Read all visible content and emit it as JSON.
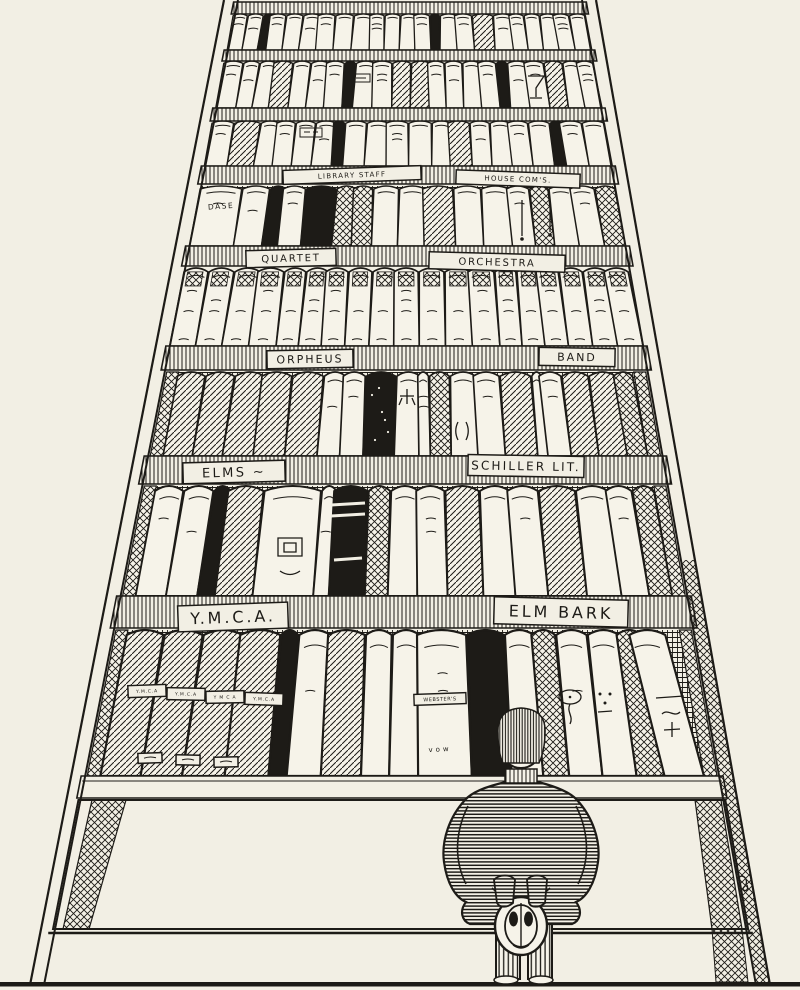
{
  "scene": {
    "description": "hand-drawn ink cartoon of a towering perspective bookcase with labeled shelves; a person stands at the bottom holding a hat behind his back",
    "colors": {
      "paper": "#f2efe4",
      "ink": "#1d1b17",
      "book_white": "#f6f3e9"
    },
    "shelf_labels": [
      {
        "text": "LIBRARY STAFF",
        "cx": 352,
        "cy": 175,
        "w": 138,
        "h": 14,
        "fs": 7,
        "rot": -2
      },
      {
        "text": "HOUSE COM'S.",
        "cx": 518,
        "cy": 179,
        "w": 124,
        "h": 14,
        "fs": 7,
        "rot": 2
      },
      {
        "text": "QUARTET",
        "cx": 291,
        "cy": 258,
        "w": 90,
        "h": 17,
        "fs": 10,
        "rot": -1.5
      },
      {
        "text": "ORCHESTRA",
        "cx": 497,
        "cy": 262,
        "w": 136,
        "h": 17,
        "fs": 10,
        "rot": 1.5
      },
      {
        "text": "ORPHEUS",
        "cx": 310,
        "cy": 359,
        "w": 86,
        "h": 18,
        "fs": 11,
        "rot": -1
      },
      {
        "text": "BAND",
        "cx": 577,
        "cy": 357,
        "w": 76,
        "h": 18,
        "fs": 11,
        "rot": 1
      },
      {
        "text": "ELMS ~",
        "cx": 234,
        "cy": 472,
        "w": 102,
        "h": 21,
        "fs": 13,
        "rot": -1.5
      },
      {
        "text": "SCHILLER LIT.",
        "cx": 526,
        "cy": 466,
        "w": 116,
        "h": 21,
        "fs": 12,
        "rot": 1
      },
      {
        "text": "Y.M.C.A.",
        "cx": 233,
        "cy": 617,
        "w": 110,
        "h": 26,
        "fs": 16,
        "rot": -2
      },
      {
        "text": "ELM BARK",
        "cx": 561,
        "cy": 612,
        "w": 134,
        "h": 27,
        "fs": 16,
        "rot": 1.5
      }
    ],
    "spine_texts": [
      {
        "text": "DASE",
        "cx": 221,
        "cy": 206,
        "fs": 7.5,
        "rot": -4,
        "ls": 1.5
      },
      {
        "text": "WEBSTER'S",
        "cx": 440,
        "cy": 699,
        "fs": 5,
        "rot": -2,
        "ls": 0.5,
        "boxw": 52,
        "boxh": 11
      },
      {
        "text": "vow",
        "cx": 440,
        "cy": 749,
        "fs": 7,
        "rot": -3,
        "ls": 3
      }
    ],
    "spine_patches": [
      {
        "text": "Y.M.C.A",
        "cx": 147,
        "cy": 691,
        "w": 38,
        "h": 12,
        "fs": 4.5,
        "rot": -2
      },
      {
        "text": "Y.M.C.A",
        "cx": 186,
        "cy": 694,
        "w": 38,
        "h": 12,
        "fs": 4.5,
        "rot": 1
      },
      {
        "text": "Y M C A",
        "cx": 225,
        "cy": 697,
        "w": 38,
        "h": 12,
        "fs": 4.5,
        "rot": -1
      },
      {
        "text": "Y.M.C.A",
        "cx": 264,
        "cy": 699,
        "w": 38,
        "h": 12,
        "fs": 4.5,
        "rot": 2
      },
      {
        "text": "",
        "cx": 150,
        "cy": 758,
        "w": 24,
        "h": 10,
        "fs": 4,
        "rot": -2
      },
      {
        "text": "",
        "cx": 188,
        "cy": 760,
        "w": 24,
        "h": 10,
        "fs": 4,
        "rot": 1
      },
      {
        "text": "",
        "cx": 226,
        "cy": 762,
        "w": 24,
        "h": 10,
        "fs": 4,
        "rot": -1
      }
    ],
    "bands": [
      {
        "y": 2,
        "h": 12
      },
      {
        "y": 50,
        "h": 11
      },
      {
        "y": 108,
        "h": 13
      },
      {
        "y": 166,
        "h": 18
      },
      {
        "y": 246,
        "h": 20
      },
      {
        "y": 346,
        "h": 24
      },
      {
        "y": 456,
        "h": 28
      },
      {
        "y": 596,
        "h": 32
      },
      {
        "y": 776,
        "h": 22,
        "plain": true
      }
    ],
    "shelves": [
      {
        "y0": 14,
        "y1": 50,
        "inset": 5,
        "books": "wwbwwwwwwwwwwbwwhwwwwww"
      },
      {
        "y0": 61,
        "y1": 108,
        "inset": 5,
        "books": "wwwhwwwbwwhhwwwwbwwhww"
      },
      {
        "y0": 121,
        "y1": 166,
        "inset": 5,
        "books": "whwwwwbwwwwwhwwwwbww"
      },
      {
        "y0": 186,
        "y1": 246,
        "inset": 6,
        "bg": "grid",
        "books": "dwbwBxxwwhwwwxwwx"
      },
      {
        "y0": 268,
        "y1": 346,
        "inset": 6,
        "books": "vvvvvvvvvvvvvvvvvvv"
      },
      {
        "y0": 372,
        "y1": 456,
        "inset": 8,
        "bg": "grid",
        "posts": true,
        "books": "hhhhhwwBwtxwwhtwhhx"
      },
      {
        "y0": 486,
        "y1": 596,
        "inset": 8,
        "bg": "grid",
        "posts": true,
        "books": "wwbhWtBxwwhwwhwwx"
      },
      {
        "y0": 630,
        "y1": 776,
        "inset": 8,
        "bg": "grid",
        "posts": true,
        "books": "HHHHbwhwwWBwxwwxl"
      }
    ]
  }
}
